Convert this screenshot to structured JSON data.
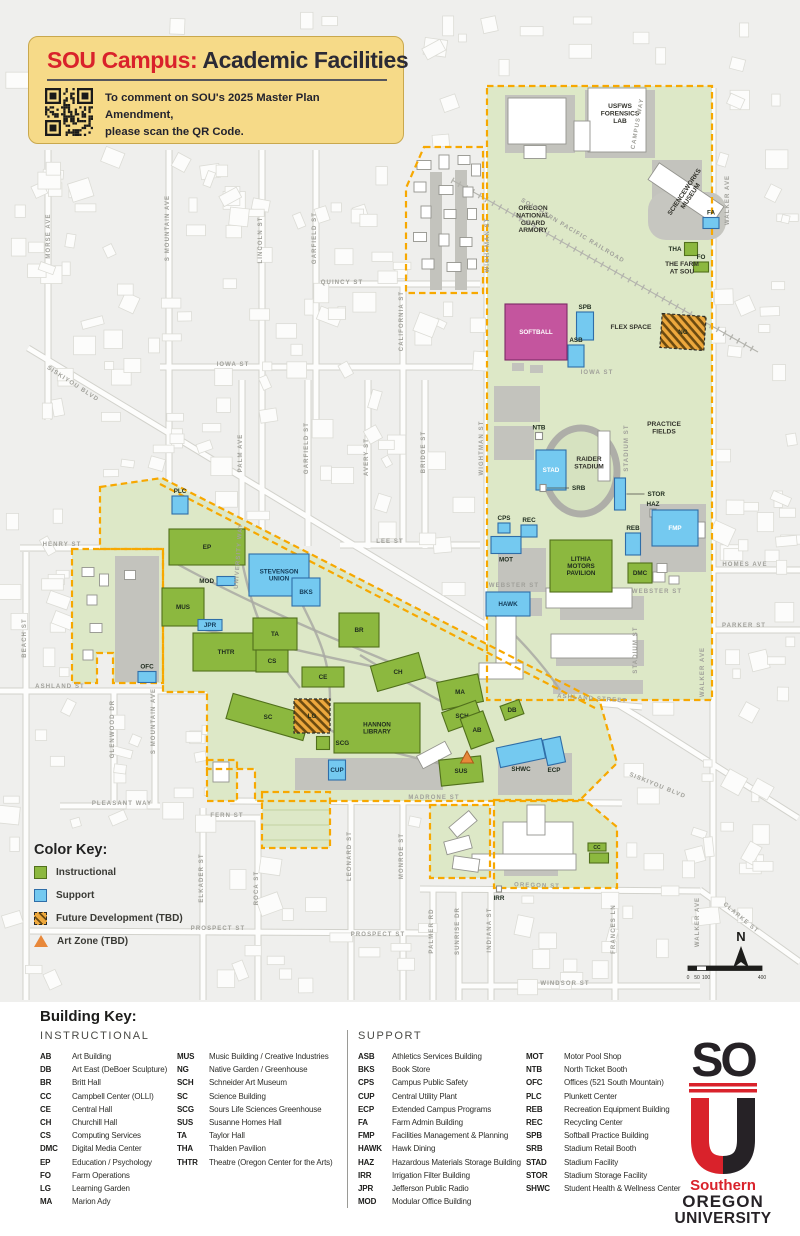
{
  "header": {
    "title_red": "SOU Campus:",
    "title_rest": " Academic Facilities",
    "qr_line1": "To comment on SOU's 2025 Master Plan Amendment,",
    "qr_line2": "please scan the QR Code."
  },
  "color_key": {
    "title": "Color Key:",
    "items": [
      {
        "label": "Instructional",
        "type": "instructional"
      },
      {
        "label": "Support",
        "type": "support"
      },
      {
        "label": "Future Development (TBD)",
        "type": "future"
      },
      {
        "label": "Art Zone (TBD)",
        "type": "artzone"
      }
    ]
  },
  "colors": {
    "instructional": "#8cb83f",
    "support": "#74c9f0",
    "future": "#eda83d",
    "art_zone": "#e8883a",
    "softball_field": "#c4559e",
    "campus_boundary": "#f7a800",
    "campus_green": "#dde8c7",
    "header_bg": "#f6da88",
    "brand_red": "#d9222b"
  },
  "compass": {
    "label": "N"
  },
  "scalebar": {
    "ticks": [
      "0",
      "50",
      "100",
      "400"
    ]
  },
  "building_key": {
    "title": "Building Key:",
    "sections": [
      {
        "title": "INSTRUCTIONAL",
        "columns": [
          [
            {
              "code": "AB",
              "name": "Art Building"
            },
            {
              "code": "DB",
              "name": "Art East (DeBoer Sculpture)"
            },
            {
              "code": "BR",
              "name": "Britt Hall"
            },
            {
              "code": "CC",
              "name": "Campbell Center (OLLI)"
            },
            {
              "code": "CE",
              "name": "Central Hall"
            },
            {
              "code": "CH",
              "name": "Churchill Hall"
            },
            {
              "code": "CS",
              "name": "Computing Services"
            },
            {
              "code": "DMC",
              "name": "Digital Media Center"
            },
            {
              "code": "EP",
              "name": "Education / Psychology"
            },
            {
              "code": "FO",
              "name": "Farm Operations"
            },
            {
              "code": "LG",
              "name": "Learning Garden"
            },
            {
              "code": "MA",
              "name": "Marion Ady"
            }
          ],
          [
            {
              "code": "MUS",
              "name": "Music Building / Creative Industries"
            },
            {
              "code": "NG",
              "name": "Native Garden / Greenhouse"
            },
            {
              "code": "SCH",
              "name": "Schneider Art Museum"
            },
            {
              "code": "SC",
              "name": "Science Building"
            },
            {
              "code": "SCG",
              "name": "Sours Life Sciences Greenhouse"
            },
            {
              "code": "SUS",
              "name": "Susanne Homes Hall"
            },
            {
              "code": "TA",
              "name": "Taylor Hall"
            },
            {
              "code": "THA",
              "name": "Thalden Pavilion"
            },
            {
              "code": "THTR",
              "name": "Theatre (Oregon Center for the Arts)"
            }
          ]
        ]
      },
      {
        "title": "SUPPORT",
        "columns": [
          [
            {
              "code": "ASB",
              "name": "Athletics Services Building"
            },
            {
              "code": "BKS",
              "name": "Book Store"
            },
            {
              "code": "CPS",
              "name": "Campus Public Safety"
            },
            {
              "code": "CUP",
              "name": "Central Utility Plant"
            },
            {
              "code": "ECP",
              "name": "Extended Campus Programs"
            },
            {
              "code": "FA",
              "name": "Farm Admin Building"
            },
            {
              "code": "FMP",
              "name": "Facilities Management & Planning"
            },
            {
              "code": "HAWK",
              "name": "Hawk Dining"
            },
            {
              "code": "HAZ",
              "name": "Hazardous Materials Storage Building"
            },
            {
              "code": "IRR",
              "name": "Irrigation Filter Building"
            },
            {
              "code": "JPR",
              "name": "Jefferson Public Radio"
            },
            {
              "code": "MOD",
              "name": "Modular Office Building"
            }
          ],
          [
            {
              "code": "MOT",
              "name": "Motor Pool Shop"
            },
            {
              "code": "NTB",
              "name": "North Ticket Booth"
            },
            {
              "code": "OFC",
              "name": "Offices (521 South Mountain)"
            },
            {
              "code": "PLC",
              "name": "Plunkett Center"
            },
            {
              "code": "REB",
              "name": "Recreation Equipment Building"
            },
            {
              "code": "REC",
              "name": "Recycling Center"
            },
            {
              "code": "SPB",
              "name": "Softball Practice Building"
            },
            {
              "code": "SRB",
              "name": "Stadium Retail Booth"
            },
            {
              "code": "STAD",
              "name": "Stadium Facility"
            },
            {
              "code": "STOR",
              "name": "Stadium Storage Facility"
            },
            {
              "code": "SHWC",
              "name": "Student Health & Wellness Center"
            }
          ]
        ]
      }
    ]
  },
  "logo": {
    "so": "SO",
    "line1": "Southern",
    "line2": "OREGON",
    "line3": "UNIVERSITY"
  },
  "map": {
    "streets": [
      {
        "t": "MORSE AVE",
        "x": 50,
        "y": 236,
        "r": -90
      },
      {
        "t": "S MOUNTAIN AVE",
        "x": 169,
        "y": 228,
        "r": -90
      },
      {
        "t": "LINCOLN ST",
        "x": 262,
        "y": 240,
        "r": -90
      },
      {
        "t": "GARFIELD ST",
        "x": 316,
        "y": 238,
        "r": -90
      },
      {
        "t": "QUINCY ST",
        "x": 342,
        "y": 284,
        "r": 0
      },
      {
        "t": "CALIFORNIA ST",
        "x": 403,
        "y": 321,
        "r": -90
      },
      {
        "t": "SISKIYOU BLVD",
        "x": 72,
        "y": 385,
        "r": 33
      },
      {
        "t": "IOWA ST",
        "x": 233,
        "y": 366,
        "r": 0
      },
      {
        "t": "IOWA ST",
        "x": 597,
        "y": 374,
        "r": 0
      },
      {
        "t": "PALM AVE",
        "x": 242,
        "y": 453,
        "r": -90
      },
      {
        "t": "GARFIELD ST",
        "x": 308,
        "y": 448,
        "r": -90
      },
      {
        "t": "AVERY ST",
        "x": 368,
        "y": 457,
        "r": -90
      },
      {
        "t": "BRIDGE ST",
        "x": 425,
        "y": 452,
        "r": -90
      },
      {
        "t": "WIGHTMAN ST",
        "x": 489,
        "y": 245,
        "r": -90
      },
      {
        "t": "WIGHTMAN ST",
        "x": 483,
        "y": 448,
        "r": -90
      },
      {
        "t": "LEE ST",
        "x": 390,
        "y": 543,
        "r": 0
      },
      {
        "t": "HENRY ST",
        "x": 62,
        "y": 546,
        "r": 0
      },
      {
        "t": "BEACH ST",
        "x": 26,
        "y": 638,
        "r": -90
      },
      {
        "t": "ASHLAND ST",
        "x": 60,
        "y": 688,
        "r": 0
      },
      {
        "t": "ASHLAND STREET",
        "x": 592,
        "y": 700,
        "r": 4
      },
      {
        "t": "WEBSTER ST",
        "x": 514,
        "y": 587,
        "r": 0
      },
      {
        "t": "WEBSTER ST",
        "x": 657,
        "y": 593,
        "r": 0
      },
      {
        "t": "STADIUM ST",
        "x": 628,
        "y": 448,
        "r": -90
      },
      {
        "t": "STADIUM ST",
        "x": 637,
        "y": 650,
        "r": -90
      },
      {
        "t": "HOMES AVE",
        "x": 745,
        "y": 566,
        "r": 0
      },
      {
        "t": "PARKER ST",
        "x": 744,
        "y": 627,
        "r": 0
      },
      {
        "t": "WALKER AVE",
        "x": 729,
        "y": 200,
        "r": -90
      },
      {
        "t": "WALKER AVE",
        "x": 704,
        "y": 672,
        "r": -90
      },
      {
        "t": "WALKER AVE",
        "x": 699,
        "y": 922,
        "r": -90
      },
      {
        "t": "CAMPUS WAY",
        "x": 639,
        "y": 124,
        "r": -80
      },
      {
        "t": "SOUTHERN PACIFIC RAILROAD",
        "x": 572,
        "y": 232,
        "r": 31
      },
      {
        "t": "UNIVERSITY WAY",
        "x": 240,
        "y": 556,
        "r": -86
      },
      {
        "t": "MADRONE ST",
        "x": 434,
        "y": 799,
        "r": 0
      },
      {
        "t": "OREGON ST",
        "x": 537,
        "y": 887,
        "r": 2
      },
      {
        "t": "GLENWOOD DR",
        "x": 114,
        "y": 729,
        "r": -90
      },
      {
        "t": "S MOUNTAIN AVE",
        "x": 155,
        "y": 721,
        "r": -90
      },
      {
        "t": "PLEASANT WAY",
        "x": 122,
        "y": 805,
        "r": 0
      },
      {
        "t": "FERN ST",
        "x": 227,
        "y": 817,
        "r": 0
      },
      {
        "t": "ELKADER ST",
        "x": 203,
        "y": 878,
        "r": -90
      },
      {
        "t": "ROCA ST",
        "x": 258,
        "y": 888,
        "r": -90
      },
      {
        "t": "LEONARD ST",
        "x": 351,
        "y": 856,
        "r": -90
      },
      {
        "t": "MONROE ST",
        "x": 403,
        "y": 856,
        "r": -90
      },
      {
        "t": "PROSPECT ST",
        "x": 218,
        "y": 930,
        "r": 0
      },
      {
        "t": "PROSPECT ST",
        "x": 378,
        "y": 936,
        "r": 0
      },
      {
        "t": "PALMER RD",
        "x": 433,
        "y": 931,
        "r": -90
      },
      {
        "t": "SUNRISE DR",
        "x": 459,
        "y": 931,
        "r": -90
      },
      {
        "t": "INDIANA ST",
        "x": 491,
        "y": 930,
        "r": -90
      },
      {
        "t": "FRANCES LN",
        "x": 615,
        "y": 929,
        "r": -90
      },
      {
        "t": "WINDSOR ST",
        "x": 565,
        "y": 985,
        "r": 0
      },
      {
        "t": "CLARKE ST",
        "x": 740,
        "y": 919,
        "r": 40
      },
      {
        "t": "SISKIYOU BLVD",
        "x": 657,
        "y": 787,
        "r": 22
      }
    ],
    "facility_labels": [
      {
        "t": "OREGON\nNATIONAL\nGUARD\nARMORY",
        "x": 533,
        "y": 210
      },
      {
        "t": "USFWS\nFORENSICS\nLAB",
        "x": 620,
        "y": 108
      },
      {
        "t": "SCIENCEWORKS\nMUSEUM",
        "x": 686,
        "y": 193,
        "r": -56
      },
      {
        "t": "THE FARM\nAT SOU",
        "x": 682,
        "y": 266
      },
      {
        "t": "FLEX SPACE",
        "x": 631,
        "y": 329
      },
      {
        "t": "PRACTICE\nFIELDS",
        "x": 664,
        "y": 426
      },
      {
        "t": "RAIDER\nSTADIUM",
        "x": 589,
        "y": 461
      }
    ],
    "buildings": [
      {
        "c": "FA",
        "t": "s",
        "x": 711,
        "y": 223,
        "w": 16,
        "h": 11,
        "lp": "above"
      },
      {
        "c": "THA",
        "t": "i",
        "x": 691,
        "y": 249,
        "w": 13,
        "h": 13,
        "lp": "left"
      },
      {
        "c": "FO",
        "t": "i",
        "x": 701,
        "y": 267,
        "w": 15,
        "h": 10,
        "lp": "above"
      },
      {
        "c": "SOFTBALL",
        "t": "m",
        "x": 536,
        "y": 332,
        "w": 62,
        "h": 56,
        "lp": "in",
        "lt": "light"
      },
      {
        "c": "SPB",
        "t": "s",
        "x": 585,
        "y": 326,
        "w": 17,
        "h": 28,
        "lp": "above"
      },
      {
        "c": "ASB",
        "t": "s",
        "x": 576,
        "y": 356,
        "w": 16,
        "h": 22,
        "lp": "above"
      },
      {
        "c": "NG",
        "t": "f",
        "x": 683,
        "y": 332,
        "w": 44,
        "h": 34,
        "r": 4,
        "lp": "in"
      },
      {
        "c": "NTB",
        "t": "w",
        "x": 539,
        "y": 436,
        "w": 7,
        "h": 7,
        "lp": "above"
      },
      {
        "c": "STAD",
        "t": "s",
        "x": 551,
        "y": 470,
        "w": 30,
        "h": 40,
        "lp": "in",
        "lt": "light"
      },
      {
        "c": "SRB",
        "t": "w",
        "x": 543,
        "y": 488,
        "w": 6,
        "h": 7,
        "lp": "right",
        "lox": 26
      },
      {
        "c": "STOR",
        "t": "s",
        "x": 620,
        "y": 494,
        "w": 11,
        "h": 32,
        "lp": "right",
        "lox": 22
      },
      {
        "c": "HAZ",
        "t": "w",
        "x": 653,
        "y": 513,
        "w": 6,
        "h": 8,
        "lp": "above"
      },
      {
        "c": "FMP",
        "t": "s",
        "x": 675,
        "y": 528,
        "w": 46,
        "h": 36,
        "lp": "in",
        "lt": "light"
      },
      {
        "c": "REB",
        "t": "s",
        "x": 633,
        "y": 544,
        "w": 15,
        "h": 22,
        "lp": "above"
      },
      {
        "c": "CPS",
        "t": "s",
        "x": 504,
        "y": 528,
        "w": 12,
        "h": 10,
        "lp": "above"
      },
      {
        "c": "REC",
        "t": "s",
        "x": 529,
        "y": 531,
        "w": 16,
        "h": 12,
        "lp": "above"
      },
      {
        "c": "MOT",
        "t": "s",
        "x": 506,
        "y": 545,
        "w": 30,
        "h": 17,
        "lp": "below"
      },
      {
        "c": "LITHIA\nMOTORS\nPAVILION",
        "t": "i",
        "x": 581,
        "y": 566,
        "w": 62,
        "h": 52,
        "lp": "in"
      },
      {
        "c": "DMC",
        "t": "i",
        "x": 640,
        "y": 573,
        "w": 24,
        "h": 20,
        "lp": "in"
      },
      {
        "c": "HAWK",
        "t": "s",
        "x": 508,
        "y": 604,
        "w": 44,
        "h": 24,
        "lp": "in"
      },
      {
        "c": "PLC",
        "t": "s",
        "x": 180,
        "y": 505,
        "w": 16,
        "h": 18,
        "lp": "above"
      },
      {
        "c": "EP",
        "t": "i",
        "x": 207,
        "y": 547,
        "w": 76,
        "h": 36,
        "lp": "in"
      },
      {
        "c": "MOD",
        "t": "s",
        "x": 226,
        "y": 581,
        "w": 18,
        "h": 9,
        "lp": "left"
      },
      {
        "c": "STEVENSON\nUNION",
        "t": "s",
        "x": 279,
        "y": 575,
        "w": 60,
        "h": 42,
        "lp": "in"
      },
      {
        "c": "BKS",
        "t": "s",
        "x": 306,
        "y": 592,
        "w": 28,
        "h": 28,
        "lp": "in"
      },
      {
        "c": "MUS",
        "t": "i",
        "x": 183,
        "y": 607,
        "w": 42,
        "h": 38,
        "lp": "in"
      },
      {
        "c": "JPR",
        "t": "s",
        "x": 210,
        "y": 625,
        "w": 24,
        "h": 11,
        "lp": "in"
      },
      {
        "c": "THTR",
        "t": "i",
        "x": 226,
        "y": 652,
        "w": 66,
        "h": 38,
        "lp": "in"
      },
      {
        "c": "TA",
        "t": "i",
        "x": 275,
        "y": 634,
        "w": 44,
        "h": 32,
        "lp": "in"
      },
      {
        "c": "CS",
        "t": "i",
        "x": 272,
        "y": 661,
        "w": 32,
        "h": 22,
        "lp": "in"
      },
      {
        "c": "BR",
        "t": "i",
        "x": 359,
        "y": 630,
        "w": 40,
        "h": 34,
        "lp": "in"
      },
      {
        "c": "CE",
        "t": "i",
        "x": 323,
        "y": 677,
        "w": 42,
        "h": 20,
        "lp": "in"
      },
      {
        "c": "CH",
        "t": "i",
        "x": 398,
        "y": 672,
        "w": 50,
        "h": 26,
        "r": -16,
        "lp": "in"
      },
      {
        "c": "MA",
        "t": "i",
        "x": 460,
        "y": 692,
        "w": 42,
        "h": 28,
        "r": -12,
        "lp": "in"
      },
      {
        "c": "SCH",
        "t": "i",
        "x": 462,
        "y": 716,
        "w": 36,
        "h": 20,
        "r": -20,
        "lp": "in"
      },
      {
        "c": "AB",
        "t": "i",
        "x": 477,
        "y": 730,
        "w": 24,
        "h": 32,
        "r": -20,
        "lp": "in"
      },
      {
        "c": "DB",
        "t": "i",
        "x": 512,
        "y": 710,
        "w": 20,
        "h": 15,
        "r": -20,
        "lp": "in"
      },
      {
        "c": "SC",
        "t": "i",
        "x": 268,
        "y": 717,
        "w": 80,
        "h": 26,
        "r": 16,
        "lp": "in"
      },
      {
        "c": "LG",
        "t": "f",
        "x": 312,
        "y": 716,
        "w": 36,
        "h": 34,
        "lp": "in"
      },
      {
        "c": "HANNON\nLIBRARY",
        "t": "i",
        "x": 377,
        "y": 728,
        "w": 86,
        "h": 50,
        "lp": "in"
      },
      {
        "c": "SCG",
        "t": "i",
        "x": 323,
        "y": 743,
        "w": 13,
        "h": 13,
        "lp": "right"
      },
      {
        "c": "CUP",
        "t": "s",
        "x": 337,
        "y": 770,
        "w": 17,
        "h": 20,
        "lp": "in"
      },
      {
        "c": "SUS",
        "t": "i",
        "x": 461,
        "y": 771,
        "w": 42,
        "h": 26,
        "r": -6,
        "lp": "in"
      },
      {
        "c": "SHWC",
        "t": "s",
        "x": 521,
        "y": 753,
        "w": 46,
        "h": 20,
        "r": -12,
        "lp": "below"
      },
      {
        "c": "ECP",
        "t": "s",
        "x": 554,
        "y": 751,
        "w": 18,
        "h": 26,
        "r": -12,
        "lp": "below"
      },
      {
        "c": "OFC",
        "t": "s",
        "x": 147,
        "y": 677,
        "w": 18,
        "h": 11,
        "lp": "above"
      },
      {
        "c": "CC",
        "t": "i",
        "x": 597,
        "y": 847,
        "w": 18,
        "h": 8,
        "lp": "in",
        "fs": 5
      },
      {
        "c": "",
        "t": "i",
        "x": 599,
        "y": 858,
        "w": 19,
        "h": 10,
        "lp": "none"
      },
      {
        "c": "IRR",
        "t": "w",
        "x": 499,
        "y": 889,
        "w": 5,
        "h": 6,
        "lp": "below"
      },
      {
        "c": "",
        "t": "a",
        "x": 467,
        "y": 757,
        "w": 13,
        "h": 12,
        "lp": "none"
      }
    ]
  }
}
